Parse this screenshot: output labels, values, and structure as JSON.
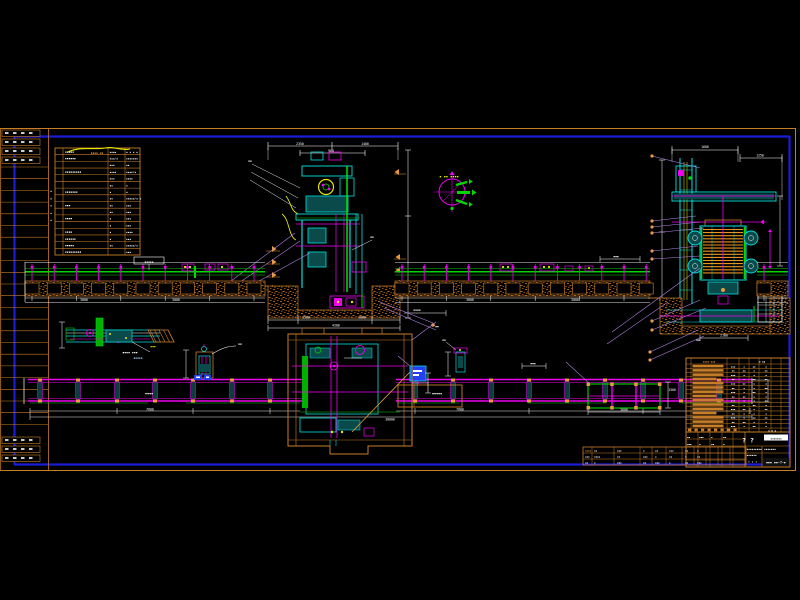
{
  "palette": {
    "frame_orange": "#c87d28",
    "bright_orange": "#e89b3c",
    "frame_blue": "#1c1cd8",
    "white": "#ffffff",
    "magenta": "#f000f0",
    "cyan": "#00e0e0",
    "teal_fill": "#0a4a4a",
    "green": "#00d800",
    "dark_green": "#008800",
    "yellow": "#e8e800",
    "purple": "#b884ea",
    "hatch_brown": "#a85c16",
    "device_blue": "#2440f0"
  },
  "labels": {
    "legend_header": "▪▪▪▪ ▪▪",
    "compass": "▪ ▪▪ ▪▪▪▪",
    "conveyor_left_note": "▪▪▪▪▪",
    "conveyor_left_plan": "▪▪▪▪",
    "conveyor_right_plan": "▪▪▪▪▪",
    "detail_a_caption": "▪▪▪▪ ▪▪▪",
    "detail_a_sub": "▪▪▪▪▪",
    "detail_a_tag": "▪▪▪"
  },
  "dims": [
    "2350",
    "1400",
    "900",
    "1500",
    "1800",
    "4200",
    "3000",
    "3000",
    "3000",
    "3000",
    "1600",
    "1250",
    "2100",
    "7600",
    "7600",
    "30000",
    "3600",
    "1500"
  ],
  "notes": [
    "▪▪▪▪",
    "▪▪▪",
    "▪▪",
    "▪▪",
    "▪▪",
    "▪▪▪",
    "▪▪",
    "▪▪",
    "▪▪"
  ],
  "legend_table": {
    "rows": [
      {
        "b": "▪▪▪▪▪",
        "c": "▪▪▪▪",
        "d": "▪ ▪ ▪ ▪"
      },
      {
        "b": "▪▪▪▪▪▪",
        "c": "▪▪▪/▪",
        "d": "▪▪▪▪▪▪▪"
      },
      {
        "b": "",
        "c": "▪▪▪",
        "d": "▪▪"
      },
      {
        "b": "▪▪▪▪▪▪▪▪▪",
        "c": "▪▪▪▪",
        "d": "▪▪▪▪/▪"
      },
      {
        "b": "",
        "c": "▪▪▪",
        "d": "▪▪▪▪"
      },
      {
        "b": "",
        "c": "▪▪",
        "d": "▪"
      },
      {
        "b": "▪▪▪▪▪▪▪",
        "c": "▪",
        "d": "▪"
      },
      {
        "b": "",
        "c": "▪▪",
        "d": "▪▪▪▪▪/▪ ▪"
      },
      {
        "b": "▪▪▪",
        "c": "▪▪",
        "d": "▪▪▪"
      },
      {
        "b": "",
        "c": "▪▪",
        "d": "▪▪▪"
      },
      {
        "b": "▪▪▪▪",
        "c": "▪",
        "d": "▪▪▪"
      },
      {
        "b": "",
        "c": "▪",
        "d": "▪▪▪"
      },
      {
        "b": "▪▪▪▪",
        "c": "▪",
        "d": "▪▪▪▪"
      },
      {
        "b": "▪▪▪▪▪▪",
        "c": "▪",
        "d": "▪▪▪"
      },
      {
        "b": "▪▪▪▪▪",
        "c": "▪▪",
        "d": "▪▪▪▪▪/▪"
      },
      {
        "b": "▪▪▪▪▪▪▪▪▪",
        "c": "",
        "d": "▪▪▪"
      }
    ],
    "side_marks": [
      "▪",
      "▪",
      "▪",
      "▪",
      "▪"
    ]
  },
  "bom_table": {
    "header_left": "▪▪▪▪-▪▪▪",
    "header_right": "▪ ▪▪",
    "rows": [
      {
        "a": "▪▪▪",
        "b": "▪",
        "c": "▪▪",
        "d": "▪"
      },
      {
        "a": "▪▪",
        "b": "▪▪",
        "c": "▪",
        "d": "▪▪"
      },
      {
        "a": "▪▪▪",
        "b": "▪",
        "c": "▪",
        "d": "▪"
      },
      {
        "a": "▪▪",
        "b": "▪",
        "c": "▪▪",
        "d": "▪▪"
      },
      {
        "a": "▪▪▪",
        "b": "▪▪",
        "c": "▪",
        "d": "▪"
      },
      {
        "a": "▪▪",
        "b": "▪",
        "c": "▪",
        "d": "▪▪"
      },
      {
        "a": "▪▪▪",
        "b": "▪",
        "c": "▪▪",
        "d": "▪"
      },
      {
        "a": "▪▪",
        "b": "▪▪",
        "c": "▪",
        "d": "▪"
      },
      {
        "a": "▪▪▪",
        "b": "▪",
        "c": "▪",
        "d": "▪▪"
      },
      {
        "a": "▪▪",
        "b": "▪",
        "c": "▪▪",
        "d": "▪"
      },
      {
        "a": "▪▪▪",
        "b": "▪▪",
        "c": "▪",
        "d": "▪▪"
      },
      {
        "a": "▪▪",
        "b": "▪",
        "c": "▪",
        "d": "▪"
      },
      {
        "a": "▪▪▪",
        "b": "▪",
        "c": "▪▪",
        "d": "▪▪"
      },
      {
        "a": "▪▪",
        "b": "▪▪",
        "c": "▪",
        "d": "▪"
      },
      {
        "a": "▪▪▪",
        "b": "▪",
        "c": "▪▪",
        "d": "▪"
      }
    ],
    "footer_right": "▪ ▪ ▪"
  },
  "title_block": {
    "mark": "? ?",
    "stamp": "▪▪▪▪▪▪▪",
    "line1": "▪▪▪▪▪▪▪▪▪",
    "line2": "▪▪▪▪▪▪",
    "extra": "▪▪▪▪▪▪▪",
    "row3": "? ? ?",
    "number": "▪▪▪ ▪▪-?-▪",
    "footer_left": "▪▪ ▪▪▪",
    "cells": [
      "▪▪",
      "▪▪▪",
      "▪",
      "▪▪",
      "▪▪▪",
      "▪",
      "▪▪",
      "▪"
    ]
  },
  "revision_strip": {
    "rows": [
      [
        "▪▪▪▪",
        "▪▪",
        "▪▪▪",
        "▪",
        "▪▪",
        "▪▪▪",
        "▪▪",
        "▪"
      ],
      [
        "▪▪▪",
        "▪▪▪▪",
        "▪▪",
        "▪▪▪",
        "▪",
        "▪▪",
        "▪",
        "▪▪"
      ],
      [
        "▪▪",
        "▪",
        "▪▪▪",
        "▪▪",
        "▪▪▪",
        "▪",
        "▪▪",
        "▪▪▪"
      ]
    ]
  }
}
